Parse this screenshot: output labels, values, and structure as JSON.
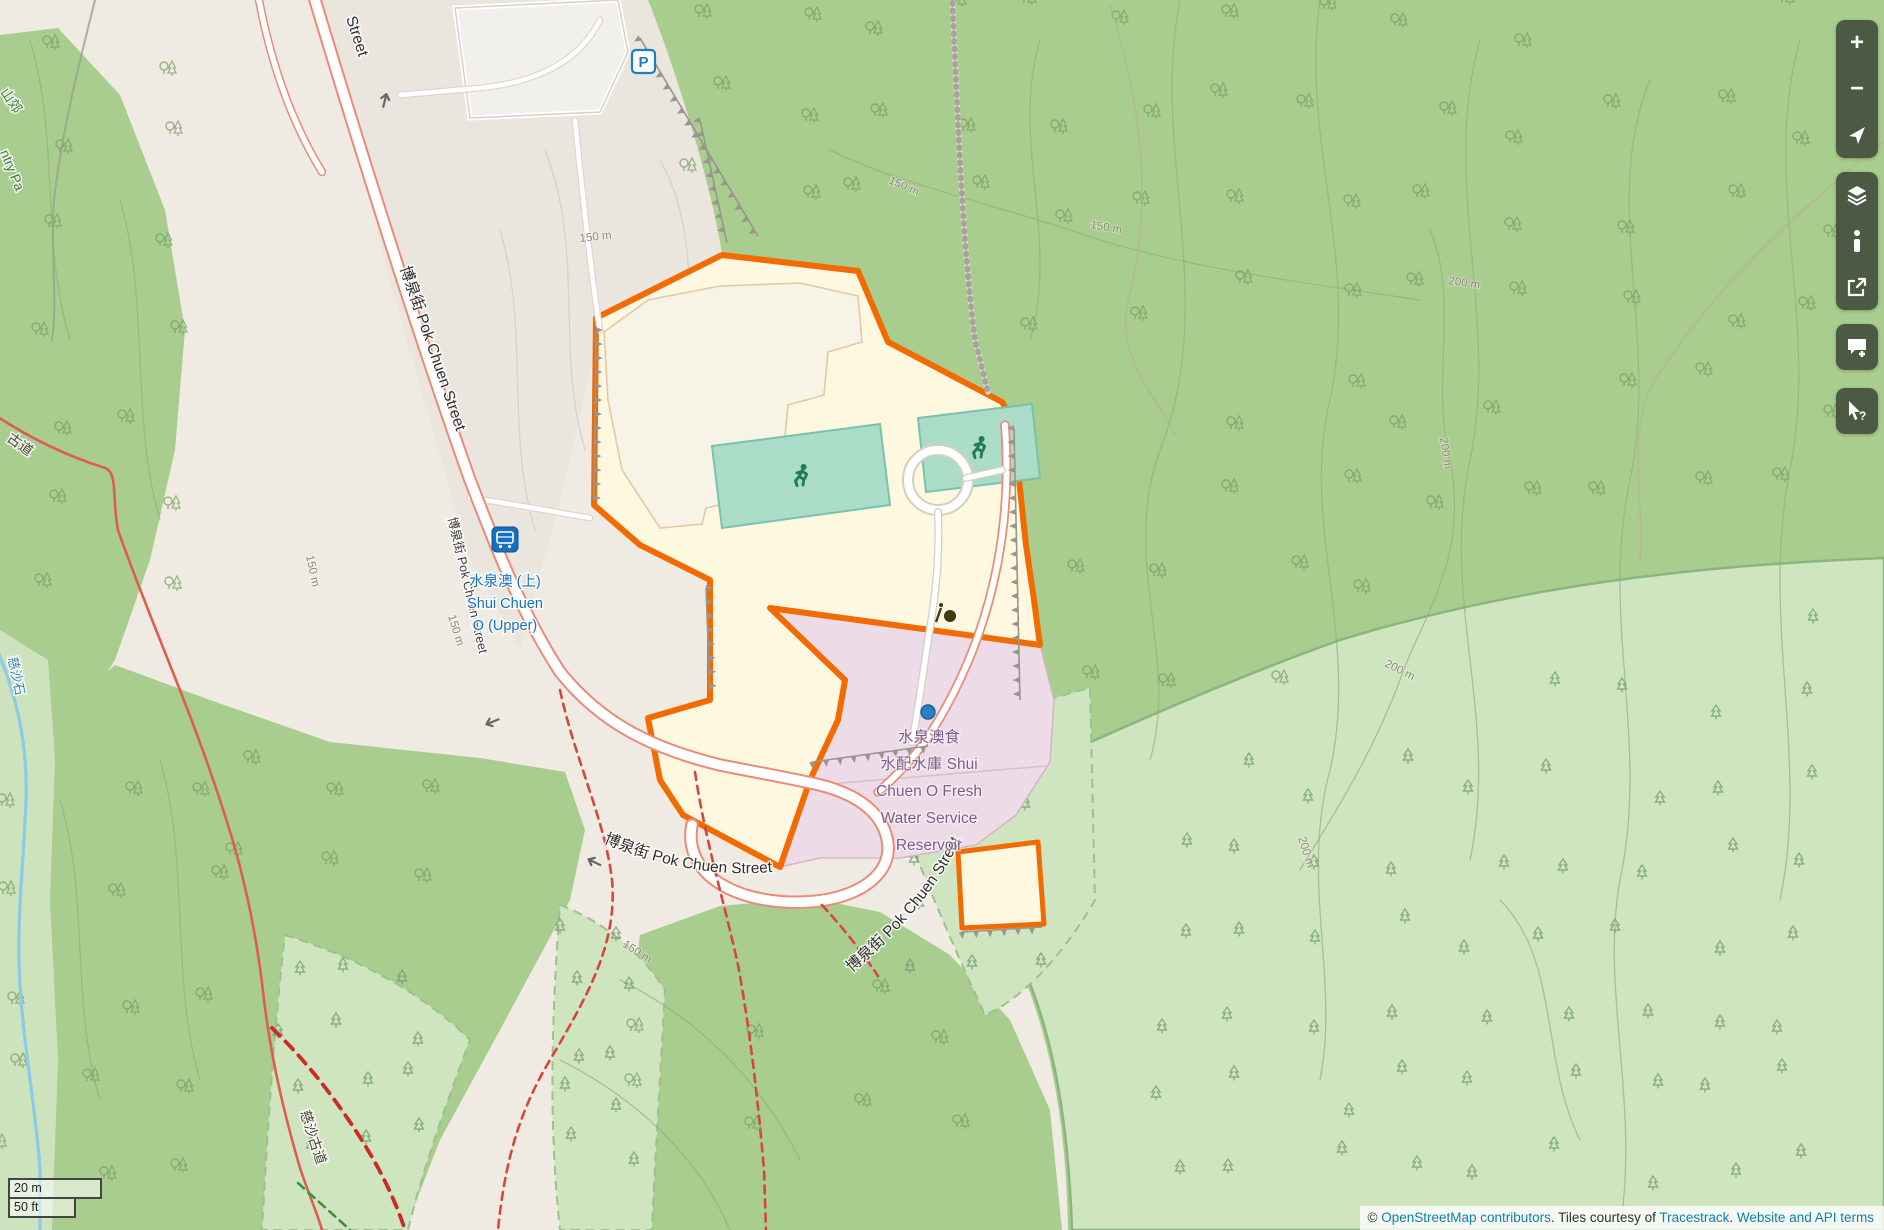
{
  "map": {
    "labels": {
      "street": "博泉街 Pok Chuen Street",
      "street_fragment": "Street",
      "bus_stop": [
        "水泉澳 (上)",
        "Shui Chuen",
        "O (Upper)"
      ],
      "reservoir": [
        "水泉澳食",
        "水配水庫 Shui",
        "Chuen O Fresh",
        "Water Service",
        "Reservoir"
      ],
      "trail": "慈沙古道",
      "trail_fragment": "古道",
      "stream_fragment": "慈沙石",
      "park_fragment_zh": "山郊",
      "park_fragment_en": "ntry Pa",
      "contour_150": "150 m",
      "contour_200": "200 m",
      "parking_letter": "P"
    },
    "colors": {
      "site_outline": "#f26a00",
      "site_fill": "#fdf8df",
      "reservoir_fill": "#eddbe8",
      "forest": "#a8cd8f",
      "plantation": "#cfe5c0",
      "road_edge": "#ec8a78",
      "bus_blue": "#1570c2",
      "marker_blue": "#2a82c6"
    }
  },
  "controls": {
    "zoom_in": "+",
    "zoom_out": "−"
  },
  "scale_bar": {
    "metric": "20 m",
    "imperial": "50 ft"
  },
  "attribution": {
    "copyright": "© ",
    "link_osm": "OpenStreetMap contributors",
    "mid1": ". Tiles courtesy of ",
    "link_tiles": "Tracestrack",
    "mid2": ". ",
    "link_terms": "Website and API terms"
  }
}
